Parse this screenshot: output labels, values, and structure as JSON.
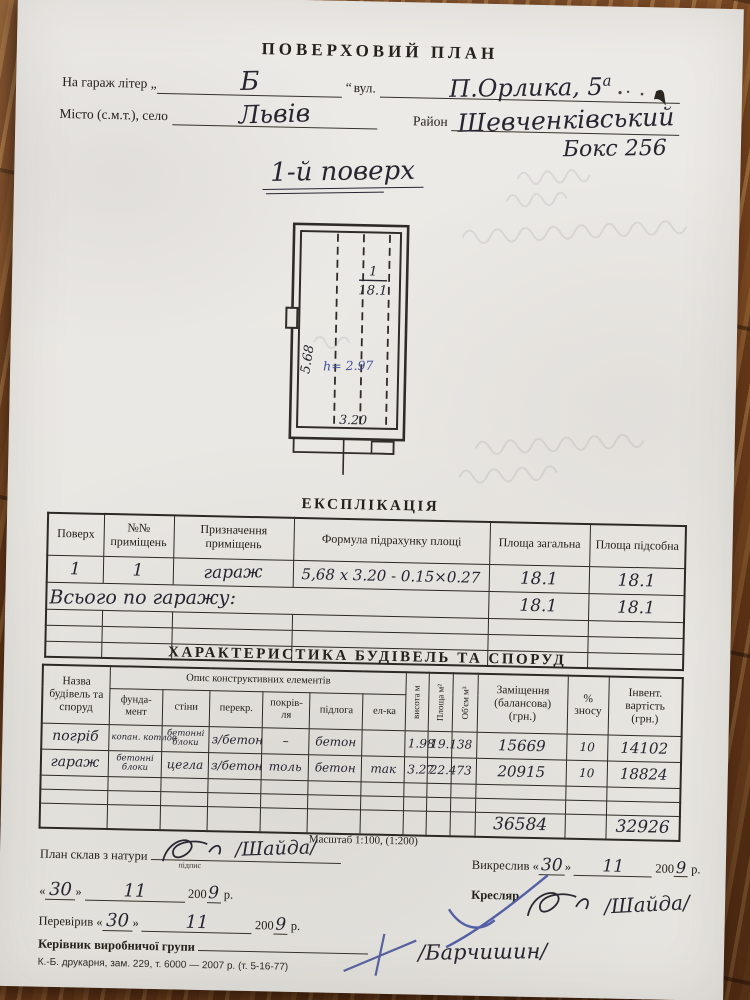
{
  "document": {
    "title": "ПОВЕРХОВИЙ ПЛАН",
    "form": {
      "garage_label": "На гараж літер „",
      "garage_letter": "Б",
      "quote_close": "“",
      "street_label": "вул.",
      "street_value": "П.Орлика, 5",
      "street_sup": "а",
      "city_label": "Місто (с.м.т.), село",
      "city_value": "Львів",
      "district_label": "Район",
      "district_value": "Шевченківський",
      "box_value": "Бокс 256"
    },
    "floor_heading": "1-й поверх",
    "plan": {
      "room_number": "1",
      "room_area": "18.1",
      "dim_left": "5.68",
      "height_note": "h= 2.97",
      "dim_bottom": "3.20"
    },
    "explication": {
      "title": "ЕКСПЛІКАЦІЯ",
      "headers": [
        "Поверх",
        "№№ приміщень",
        "Призначення приміщень",
        "Формула підрахунку площі",
        "Площа загальна",
        "Площа підсобна"
      ],
      "row1": {
        "floor": "1",
        "room_no": "1",
        "purpose": "гараж",
        "formula": "5,68 х 3.20 - 0.15×0.27",
        "area_total": "18.1",
        "area_aux": "18.1"
      },
      "row_total": {
        "label": "Всього по гаражу:",
        "area_total": "18.1",
        "area_aux": "18.1"
      }
    },
    "characteristics": {
      "title": "ХАРАКТЕРИСТИКА БУДІВЕЛЬ ТА СПОРУД",
      "name_header": "Назва будівель та споруд",
      "desc_group_header": "Опис конструктивних елементів",
      "desc_headers": [
        "фунда- мент",
        "стіни",
        "перекр.",
        "покрів- ля",
        "підлога",
        "ел-ка"
      ],
      "v_headers": [
        "висота м",
        "Площа м²",
        "Об'єм м³"
      ],
      "replacement_header": "Заміщення (балансова) (грн.)",
      "wear_header": "% зносу",
      "inventory_header": "Інвент. вартість (грн.)",
      "rows": [
        {
          "name": "погріб",
          "foundation": "копан. котлов.",
          "walls": "бетонні блоки",
          "ceiling": "з/бетон",
          "roof": "–",
          "floor": "бетон",
          "electric": "",
          "height": "1.98",
          "area": "19.1",
          "volume": "38",
          "replacement": "15669",
          "wear": "10",
          "inventory": "14102"
        },
        {
          "name": "гараж",
          "foundation": "бетонні блоки",
          "walls": "цегла",
          "ceiling": "з/бетон",
          "roof": "толь",
          "floor": "бетон",
          "electric": "так",
          "height": "3.27",
          "area": "22.4",
          "volume": "73",
          "replacement": "20915",
          "wear": "10",
          "inventory": "18824"
        }
      ],
      "totals": {
        "replacement": "36584",
        "inventory": "32926"
      }
    },
    "scale_note": "Масштаб 1:100, (1:200)",
    "signatures": {
      "plan_made_label": "План склав з натури",
      "signature_caption": "підпис",
      "drafter_signature": "/Шайда/",
      "date": {
        "open": "«",
        "day": "30",
        "close": "»",
        "month": "11",
        "year_prefix": "200",
        "year_digit": "9",
        "year_suffix": "р."
      },
      "drawn_label": "Викреслив",
      "draftsman_label": "Кресляр",
      "checked_label": "Перевірив",
      "head_label": "Керівник виробничої групи",
      "head_signature": "/Барчишин/"
    },
    "print_footer": "К.-Б. друкарня, зам. 229, т. 6000 — 2007 р. (т. 5-16-77)",
    "ink_colors": {
      "handwriting": "#282531",
      "blue_pen": "#44529f"
    }
  }
}
